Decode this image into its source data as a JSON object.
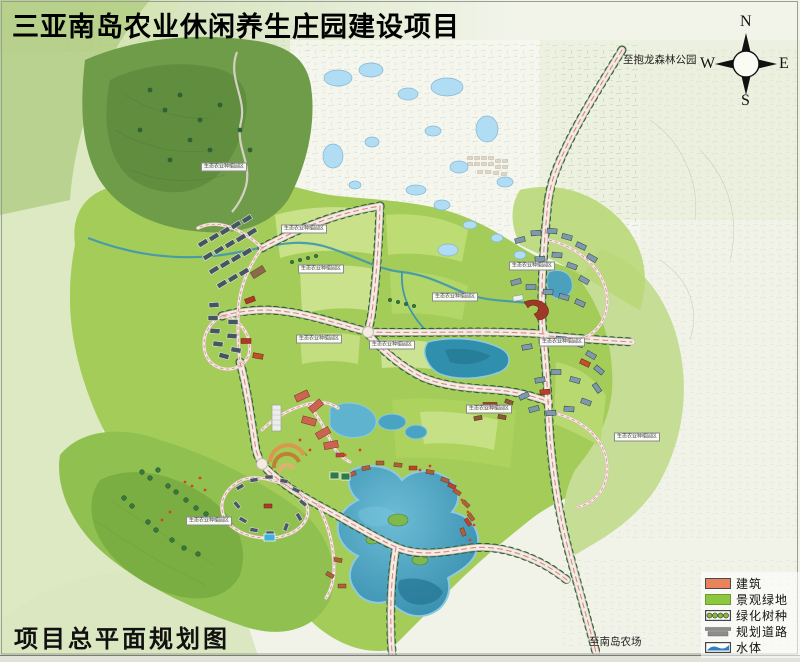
{
  "title": "三亚南岛农业休闲养生庄园建设项目",
  "caption": "项目总平面规划图",
  "compass": {
    "n": "N",
    "e": "E",
    "s": "S",
    "w": "W"
  },
  "road_labels": {
    "to_baolong_forest_park": "至抱龙森林公园",
    "to_nandao_farm": "至南岛农场"
  },
  "legend": {
    "items": [
      {
        "label": "建筑",
        "color": "#e8835c"
      },
      {
        "label": "景观绿地",
        "color": "#8dc63f"
      },
      {
        "label": "绿化树种",
        "color": "#86b83a"
      },
      {
        "label": "规划道路",
        "color": "#8c8c8c"
      },
      {
        "label": "水体",
        "color": "#2f7fc4"
      }
    ]
  },
  "map": {
    "area_labels": [
      {
        "text": "生态农业种植园区",
        "x": 304,
        "y": 229
      },
      {
        "text": "生态农业种植园区",
        "x": 321,
        "y": 269
      },
      {
        "text": "生态农业种植园区",
        "x": 455,
        "y": 297
      },
      {
        "text": "生态农业种植园区",
        "x": 319,
        "y": 339
      },
      {
        "text": "生态农业种植园区",
        "x": 392,
        "y": 345
      },
      {
        "text": "生态农业种植园区",
        "x": 224,
        "y": 167
      },
      {
        "text": "生态农业种植园区",
        "x": 209,
        "y": 521
      },
      {
        "text": "生态农业种植园区",
        "x": 532,
        "y": 266
      },
      {
        "text": "生态农业种植园区",
        "x": 489,
        "y": 409
      },
      {
        "text": "生态农业种植园区",
        "x": 562,
        "y": 342
      },
      {
        "text": "生态农业种植园区",
        "x": 637,
        "y": 437
      }
    ]
  }
}
